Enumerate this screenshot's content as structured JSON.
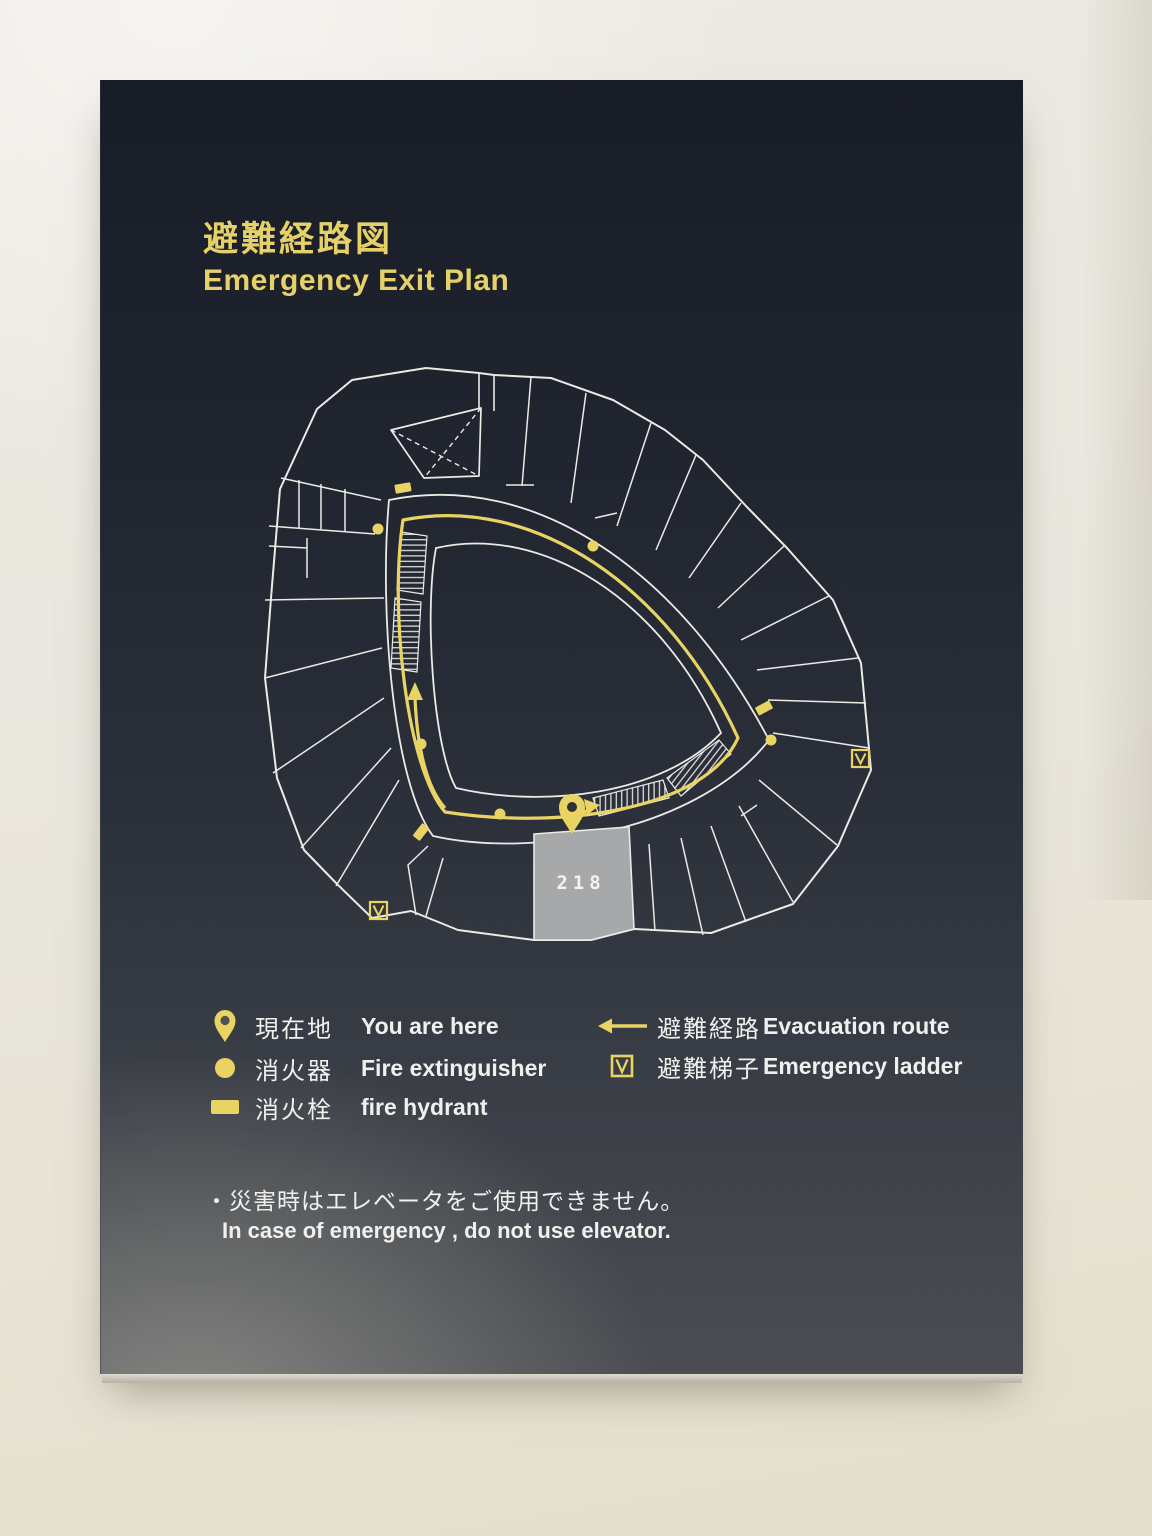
{
  "sign": {
    "title_ja": "避難経路図",
    "title_en": "Emergency Exit Plan",
    "notice_ja": "・災害時はエレベータをご使用できません。",
    "notice_en": "In case of emergency , do not use elevator."
  },
  "map": {
    "room_label": "218"
  },
  "legend": {
    "left": [
      {
        "icon": "you-are-here-pin-icon",
        "ja": "現在地",
        "en": "You are here"
      },
      {
        "icon": "fire-extinguisher-icon",
        "ja": "消火器",
        "en": "Fire extinguisher"
      },
      {
        "icon": "fire-hydrant-icon",
        "ja": "消火栓",
        "en": "fire hydrant"
      }
    ],
    "right": [
      {
        "icon": "evacuation-route-arrow-icon",
        "ja": "避難経路",
        "en": "Evacuation route"
      },
      {
        "icon": "emergency-ladder-icon",
        "ja": "避難梯子",
        "en": "Emergency ladder"
      }
    ]
  },
  "colors": {
    "accent_yellow": "#e9d463",
    "line_white": "#eceae5",
    "panel_dark": "#232834",
    "room_fill": "#a7a8aa",
    "wall": "#eae7df"
  }
}
